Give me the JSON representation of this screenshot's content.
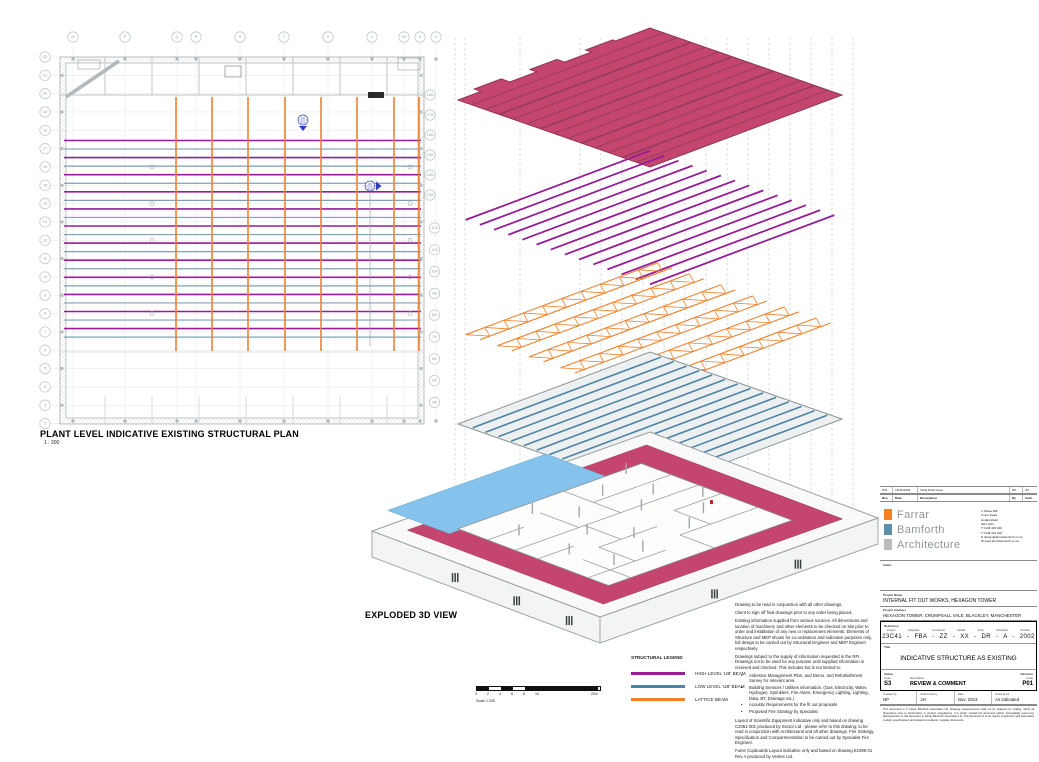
{
  "sheet": {
    "plan_title": "PLANT LEVEL INDICATIVE EXISTING STRUCTURAL PLAN",
    "plan_scale": "1 : 200",
    "exploded_title": "EXPLODED 3D VIEW"
  },
  "colors": {
    "high_beam": "#951d95",
    "low_beam": "#4d84a4",
    "lattice": "#f1812c",
    "plan_low_beam": "#7fa0b4",
    "roof": "#c4466e",
    "roof_edge": "#8f3354",
    "roof_rib": "#963a5f",
    "slab_blue": "#85c3ec",
    "logo_orange": "#f5821f",
    "logo_blue": "#5b8fa8",
    "logo_gray": "#b7bcbe",
    "marker_blue": "#2b3fc0"
  },
  "plan": {
    "grid_top": [
      "M",
      "P",
      "Q",
      "R",
      "S",
      "T",
      "U",
      "V",
      "W",
      "X",
      "Y"
    ],
    "grid_left": [
      "22",
      "21",
      "20",
      "19",
      "18",
      "17",
      "16",
      "15",
      "14",
      "13",
      "12",
      "11",
      "10",
      "9",
      "8",
      "7",
      "6",
      "5",
      "4",
      "3",
      "2"
    ],
    "grid_right_upper": [
      "18A",
      "17A",
      "16A",
      "15A",
      "14A",
      "13A"
    ],
    "grid_right_lower": [
      "12A",
      "11A",
      "10A",
      "9A",
      "8A",
      "7A",
      "6A",
      "5A",
      "4A"
    ],
    "section_marker": {
      "top": "8.8",
      "bottom": "2002"
    }
  },
  "legend": {
    "title": "STRUCTURAL LEGEND",
    "items": [
      {
        "label": "HIGH LEVEL 'UB' BEAM",
        "color_key": "high_beam"
      },
      {
        "label": "LOW LEVEL 'UB' BEAM",
        "color_key": "low_beam"
      },
      {
        "label": "LATTICE BEAM",
        "color_key": "lattice"
      }
    ]
  },
  "scale_bar": {
    "ticks": [
      "0",
      "2",
      "4",
      "6",
      "8",
      "10"
    ],
    "end_label": "20m",
    "caption": "Scale 1:200"
  },
  "notes": {
    "paragraphs": [
      "Drawing to be read in conjunction with all other drawings.",
      "Client to sign off final drawings prior to any order being placed.",
      "Existing information supplied from various sources. All dimensions and location of machinery and other elements to be checked on site prior to order and installation of any new or replacement elements. Elements of Structure and MEP shown for co-ordination and indicative purposes only, full design to be carried out by Structural Engineer and MEP Engineer respectively.",
      "Drawings subject to the supply of information requested in the RFI. Drawings not to be used for any purpose until supplied information is received and checked. This includes but is not limited to:"
    ],
    "bullets": [
      "Asbestos Management Plan, and Demo. and Refurbishment Survey for relevant area",
      "Building Services / Utilities information. (Gas, Electricity, Water, Hydrogen, Sprinklers, Fire Alarm, Emergency Lighting, Lighting, Data, BT, Drainage etc.)",
      "Acoustic Requirements for the fit out proposals",
      "Proposed Fire Strategy by Specialist"
    ],
    "paragraphs2": [
      "Layout of Scientific Equipment indicative only and based on drawing C2361-001 produced by Sector Ltd - please refer to this drawing; to be read in conjunction with Architectural and all other drawings. Fire Strategy, Specification and Compartmentation to be carried out by Specialist Fire Engineer.",
      "Fume Cupboards Layout indicative only and based on drawing E1085-01 Rev A produced by Ventex Ltd."
    ]
  },
  "title_block": {
    "revision_row": {
      "rev": "P01",
      "date": "16/11/2023",
      "description": "Initial Draft Issue",
      "by": "NP",
      "auth": "JH"
    },
    "revision_headers": {
      "rev": "Rev.",
      "date": "Date",
      "description": "Description",
      "by": "By",
      "auth": "Auth."
    },
    "logo": {
      "line1": "Farrar",
      "line2": "Bamforth",
      "line3": "Architecture"
    },
    "address_lines": [
      "4, Bates Mill",
      "Colne Road",
      "Huddersfield",
      "HD1 3AG",
      "T 0148 436 300",
      "T 0148 412 300",
      "E design@farrarbamforth.co.uk",
      "W www.farrarbamforth.co.uk"
    ],
    "client_label": "Client",
    "project_name_label": "Project Name",
    "project_name": "INTERNAL FIT OUT WORKS, HEXAGON TOWER",
    "project_address_label": "Project Address",
    "project_address": "HEXAGON TOWER, CRUMPSALL VALE, BLACKLEY, MANCHESTER",
    "reference_label": "Reference",
    "reference_headers": [
      "Project",
      "Originator",
      "Functional",
      "Spatial",
      "Form",
      "Discipline",
      "Number"
    ],
    "reference_values": [
      "23C41",
      "FBA",
      "ZZ",
      "XX",
      "DR",
      "A",
      "2002"
    ],
    "title_label": "Title",
    "drawing_title": "INDICATIVE STRUCTURE AS EXISTING",
    "status_label": "Status",
    "status_code_label": "Code",
    "status_code": "S3",
    "status_desc_label": "Description",
    "status_desc": "REVIEW & COMMENT",
    "revision_label": "Revision",
    "revision_code_label": "Code",
    "revision_code": "P01",
    "created_by_label": "Created by",
    "created_by": "NP",
    "authorised_by_label": "Authorised by",
    "authorised_by": "JH",
    "date_label": "Date",
    "date": "Nov. 2023",
    "scale_label": "Scale at A1",
    "scale": "As indicated",
    "disclaimer": "This document is © Farrar Bamforth Associates Ltd. Drawing measurements shall not be obtained by scaling. Verify all dimensions prior to construction or product manufacture. If in doubt, contact the document author. Immediately report any discrepancies on this document to Farrar Bamforth Associates Ltd. This document is to be read in conjunction with associated models, specifications and related consultants / supplier documents."
  }
}
